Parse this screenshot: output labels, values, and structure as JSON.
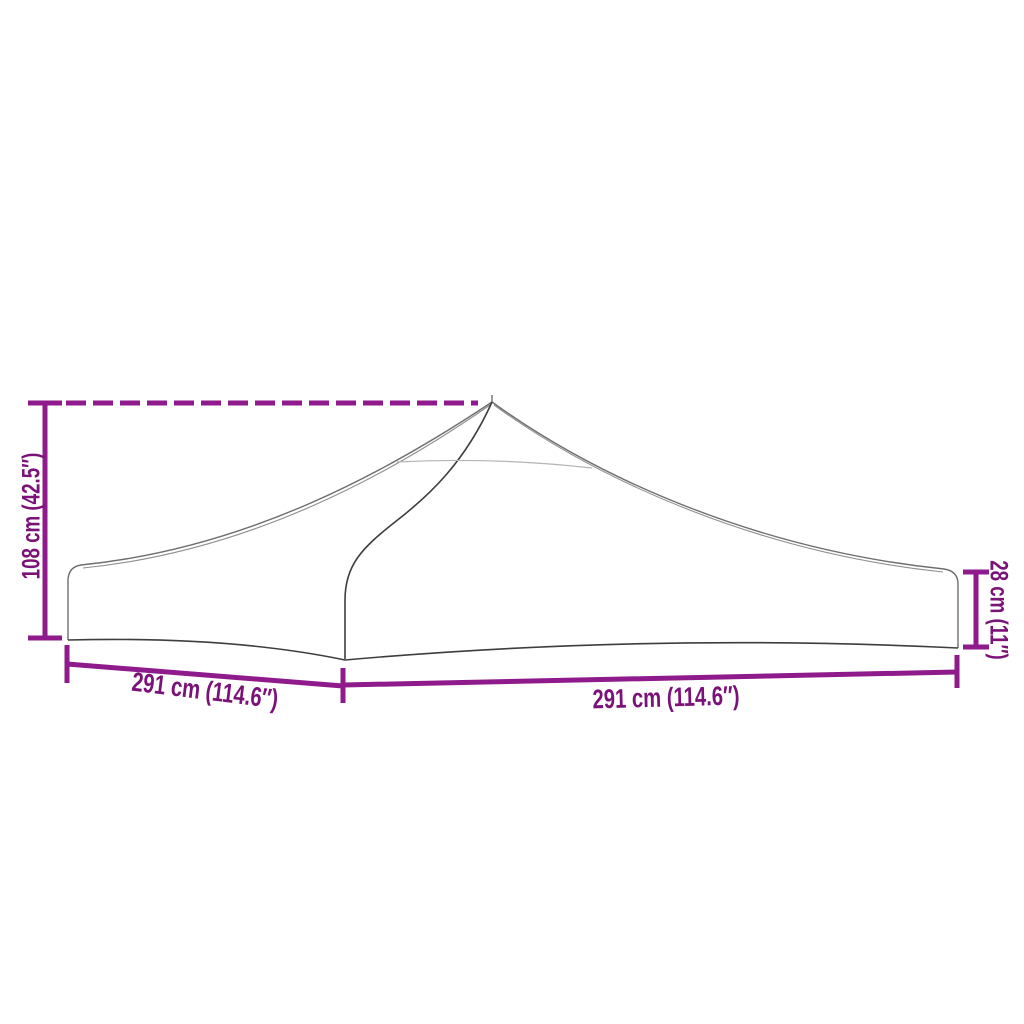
{
  "page": {
    "background_color": "#FFFFFF"
  },
  "diagram": {
    "colors": {
      "dimension_line": "#8E1A8C",
      "dimension_text": "#7A1278",
      "product_outline": "#6E6E6E",
      "product_outline_dark": "#3E3E3E",
      "product_outline_faint": "#B5B5B5"
    },
    "dimensions": {
      "height": {
        "value": "108 cm (42.5″)"
      },
      "depth": {
        "value": "291 cm (114.6″)"
      },
      "width": {
        "value": "291 cm (114.6″)"
      },
      "valance_height": {
        "value": "28 cm (11″)"
      }
    }
  }
}
